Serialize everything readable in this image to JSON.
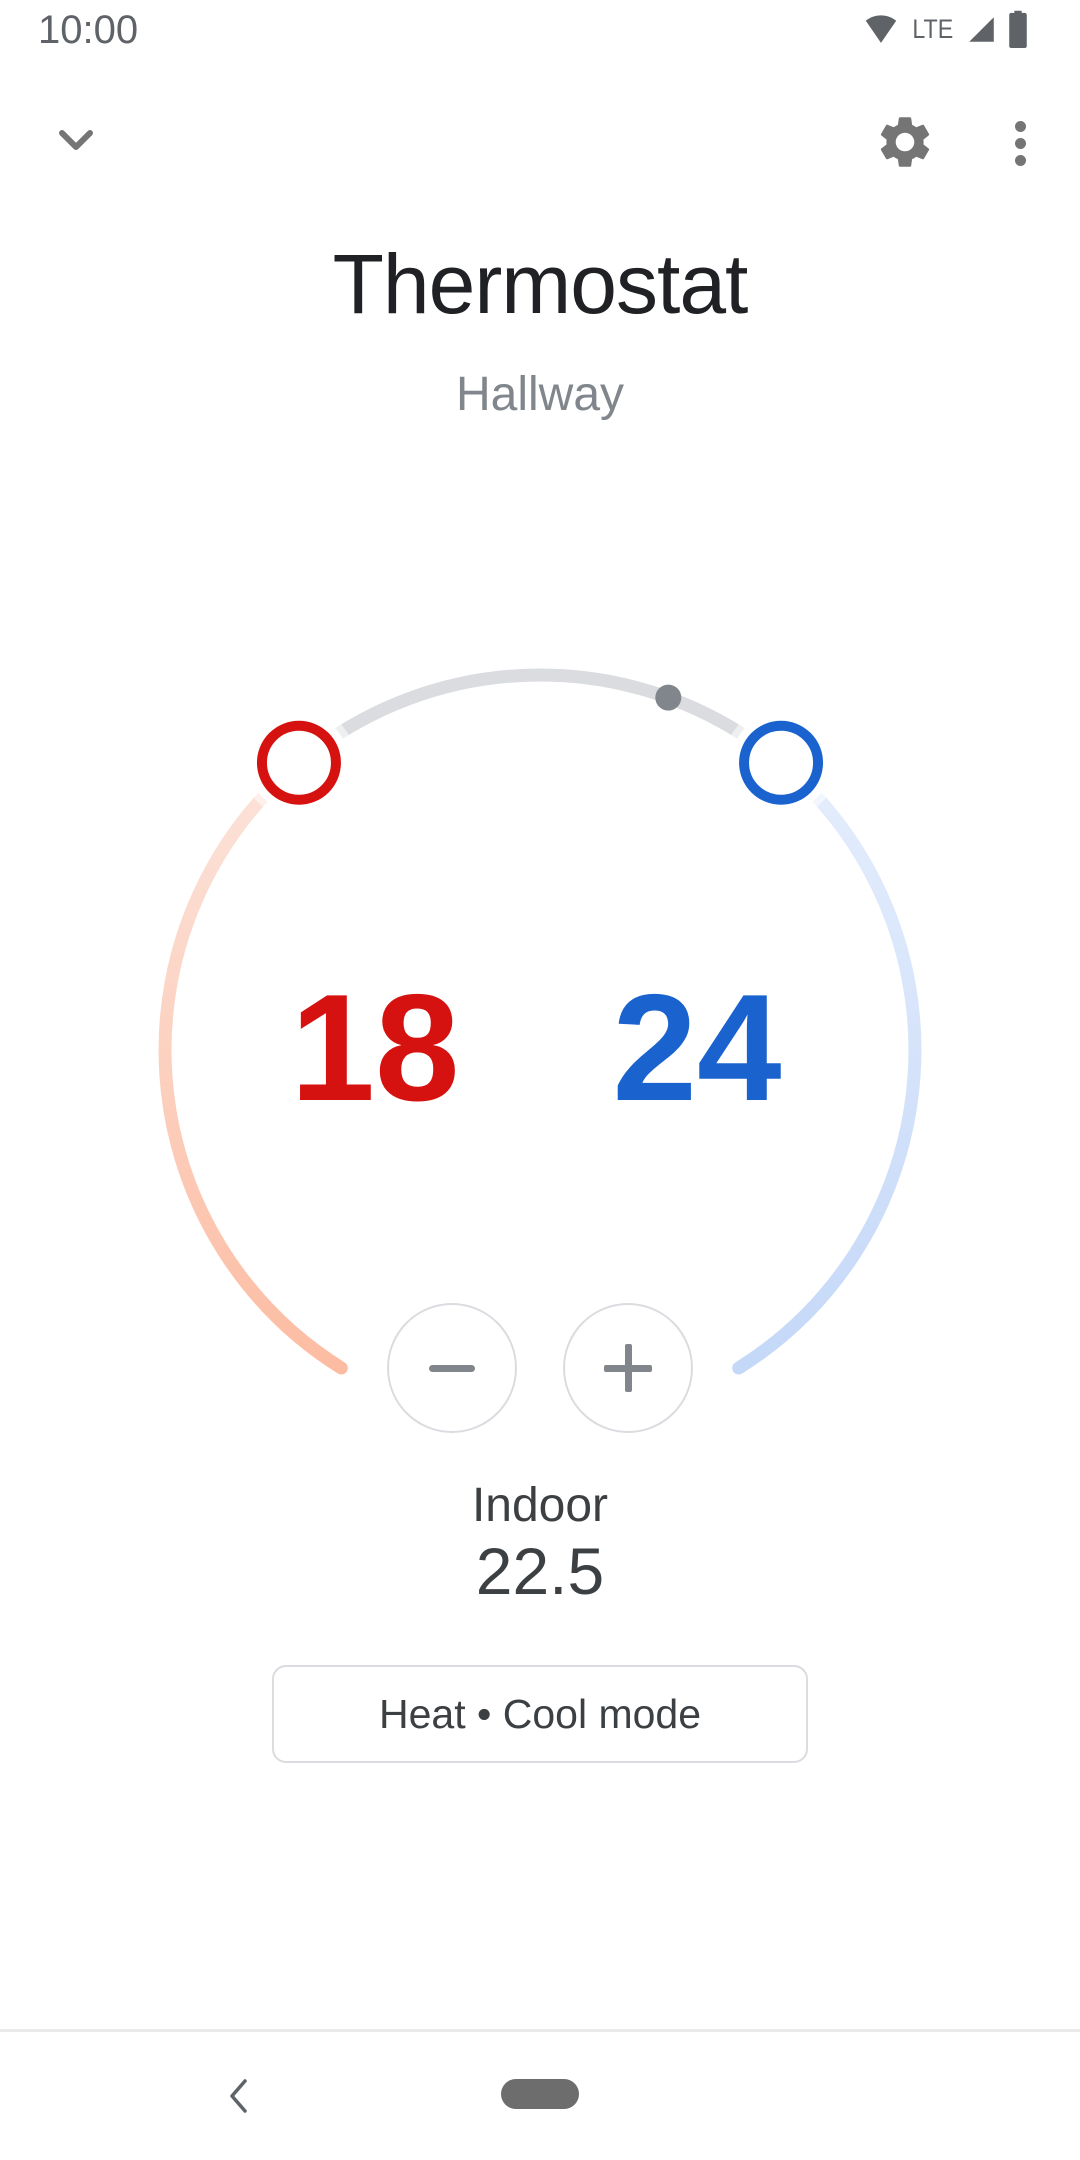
{
  "theme": {
    "heat-color": "#d5120f",
    "cool-color": "#1a63cf",
    "heat-arc-start": "#fce3da",
    "heat-arc-end": "#fcbca2",
    "cool-arc-start": "#e4edfc",
    "cool-arc-end": "#c4d8f8",
    "track-color": "#dadce0",
    "dot-color": "#80868b",
    "icon-gray": "#757575",
    "status-gray": "#5f6368",
    "title-color": "#202124",
    "subtitle-color": "#80868b",
    "body-color": "#3c4043",
    "border-color": "#dadce0",
    "control-gray": "#80868b",
    "pill-color": "#6d6d6d"
  },
  "status_bar": {
    "time": "10:00",
    "network": "LTE"
  },
  "app_bar": {
    "title": "Thermostat",
    "subtitle": "Hallway"
  },
  "dial": {
    "heat_setpoint": "18",
    "cool_setpoint": "24"
  },
  "ambient": {
    "label": "Indoor",
    "value": "22.5"
  },
  "mode": {
    "label": "Heat • Cool mode"
  }
}
